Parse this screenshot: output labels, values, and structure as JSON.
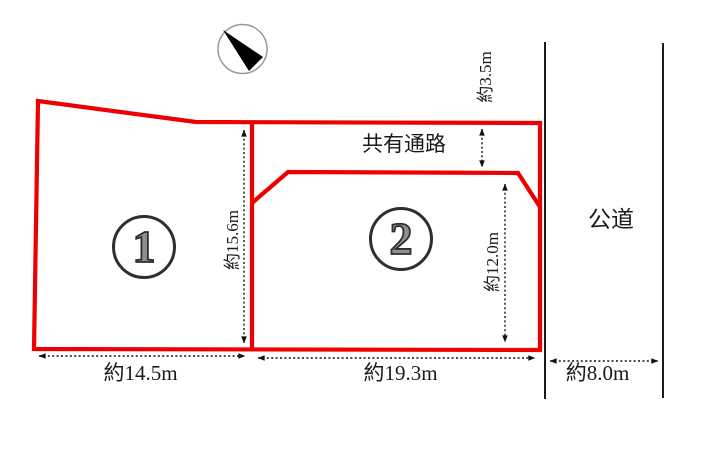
{
  "diagram": {
    "title": "land-plot-layout",
    "parcels": [
      {
        "number": "1",
        "frontage": "約14.5m",
        "depth": "約15.6m"
      },
      {
        "number": "2",
        "frontage": "約19.3m",
        "depth": "約12.0m"
      }
    ],
    "passage": {
      "label": "共有通路",
      "width": "約3.5m"
    },
    "road": {
      "label": "公道",
      "width": "約8.0m"
    },
    "icons": {
      "compass": "north-arrow-icon"
    },
    "colors": {
      "parcel_outline": "#ee0000",
      "road_line": "#1a1a1a",
      "dimension_line": "#111111",
      "text": "#1a1a1a",
      "badge_digit": "#909090",
      "badge_outline": "#2f2f2f",
      "compass_ring": "#999999",
      "compass_needle": "#000000"
    }
  }
}
